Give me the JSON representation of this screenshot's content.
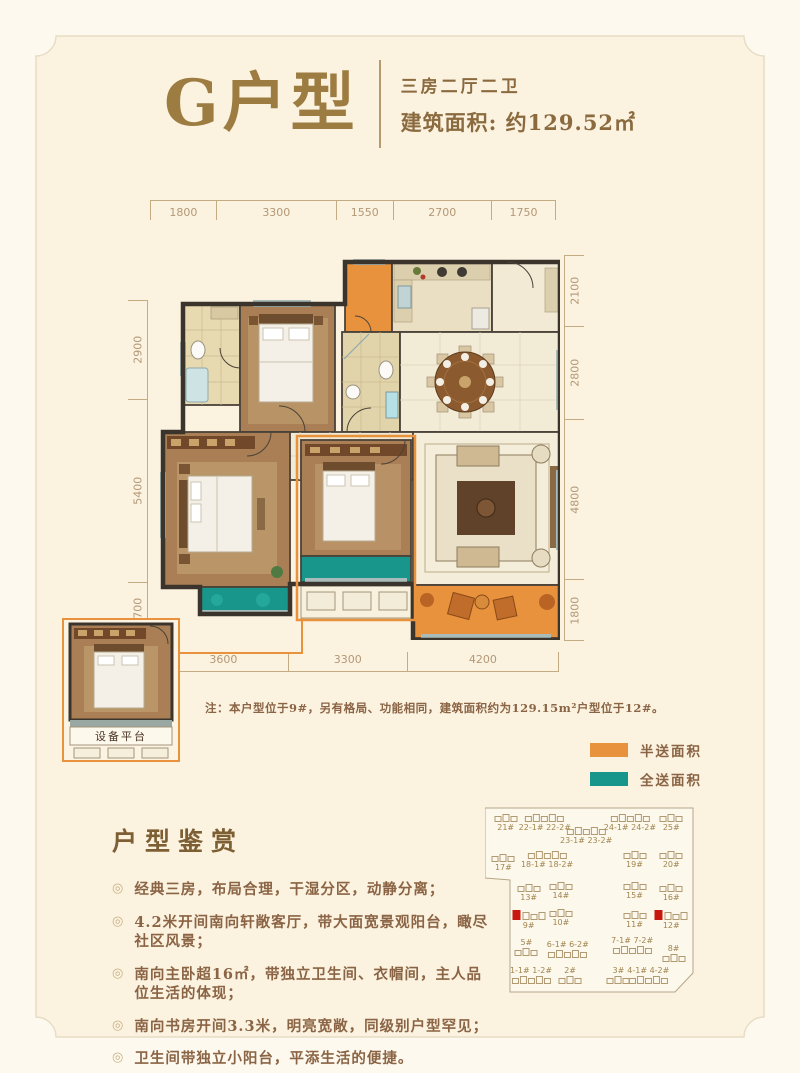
{
  "header": {
    "title": "G户型",
    "config": "三房二厅二卫",
    "area": "建筑面积: 约129.52㎡"
  },
  "floorplan": {
    "dims": {
      "top": [
        "1800",
        "3300",
        "1550",
        "2700",
        "1750"
      ],
      "right": [
        "2100",
        "2800",
        "4800",
        "1800"
      ],
      "left": [
        "2900",
        "5400",
        "1700"
      ],
      "bottom": [
        "3600",
        "3300",
        "4200"
      ]
    },
    "note": "注：本户型位于9#，另有格局、功能相同，建筑面积约为129.15m²户型位于12#。",
    "inset": {
      "label": "设备平台"
    }
  },
  "legend": {
    "items": [
      {
        "name": "half-gift-area",
        "label": "半送面积",
        "color": "#e8923d"
      },
      {
        "name": "full-gift-area",
        "label": "全送面积",
        "color": "#19968b"
      }
    ]
  },
  "appreciation": {
    "title": "户型鉴赏",
    "bullet": "◎",
    "items": [
      "经典三房，布局合理，干湿分区，动静分离；",
      "4.2米开间南向轩敞客厅，带大面宽景观阳台，瞰尽社区风景；",
      "南向主卧超16㎡，带独立卫生间、衣帽间，主人品位生活的体现；",
      "南向书房开间3.3米，明亮宽敞，同级别户型罕见；",
      "卫生间带独立小阳台，平添生活的便捷。"
    ]
  },
  "siteplan": {
    "highlight_color": "#c8170e",
    "buildings": [
      {
        "label": "21#",
        "x": 9,
        "y": 10,
        "pos": "below",
        "red": false
      },
      {
        "label": "22-1# 22-2#",
        "x": 26,
        "y": 10,
        "pos": "below",
        "red": false
      },
      {
        "label": "23-1# 23-2#",
        "x": 44,
        "y": 17,
        "pos": "below",
        "red": false
      },
      {
        "label": "24-1# 24-2#",
        "x": 63,
        "y": 10,
        "pos": "below",
        "red": false
      },
      {
        "label": "25#",
        "x": 81,
        "y": 10,
        "pos": "below",
        "red": false
      },
      {
        "label": "17#",
        "x": 8,
        "y": 31,
        "pos": "below",
        "red": false
      },
      {
        "label": "18-1# 18-2#",
        "x": 27,
        "y": 29,
        "pos": "below",
        "red": false
      },
      {
        "label": "19#",
        "x": 65,
        "y": 29,
        "pos": "below",
        "red": false
      },
      {
        "label": "20#",
        "x": 81,
        "y": 29,
        "pos": "below",
        "red": false
      },
      {
        "label": "13#",
        "x": 19,
        "y": 46,
        "pos": "below",
        "red": false
      },
      {
        "label": "14#",
        "x": 33,
        "y": 45,
        "pos": "below",
        "red": false
      },
      {
        "label": "15#",
        "x": 65,
        "y": 45,
        "pos": "below",
        "red": false
      },
      {
        "label": "16#",
        "x": 81,
        "y": 46,
        "pos": "below",
        "red": false
      },
      {
        "label": "9#",
        "x": 19,
        "y": 60,
        "pos": "below",
        "red": true
      },
      {
        "label": "10#",
        "x": 33,
        "y": 59,
        "pos": "below",
        "red": false
      },
      {
        "label": "11#",
        "x": 65,
        "y": 60,
        "pos": "below",
        "red": false
      },
      {
        "label": "12#",
        "x": 81,
        "y": 60,
        "pos": "below",
        "red": true
      },
      {
        "label": "5#",
        "x": 18,
        "y": 74,
        "pos": "above",
        "red": false
      },
      {
        "label": "6-1# 6-2#",
        "x": 36,
        "y": 75,
        "pos": "above",
        "red": false
      },
      {
        "label": "7-1# 7-2#",
        "x": 64,
        "y": 73,
        "pos": "above",
        "red": false
      },
      {
        "label": "8#",
        "x": 82,
        "y": 77,
        "pos": "above",
        "red": false
      },
      {
        "label": "1-1# 1-2#",
        "x": 20,
        "y": 88,
        "pos": "above",
        "red": false
      },
      {
        "label": "2#",
        "x": 37,
        "y": 88,
        "pos": "above",
        "red": false
      },
      {
        "label": "3#",
        "x": 58,
        "y": 88,
        "pos": "above",
        "red": false
      },
      {
        "label": "4-1# 4-2#",
        "x": 71,
        "y": 88,
        "pos": "above",
        "red": false
      }
    ]
  }
}
